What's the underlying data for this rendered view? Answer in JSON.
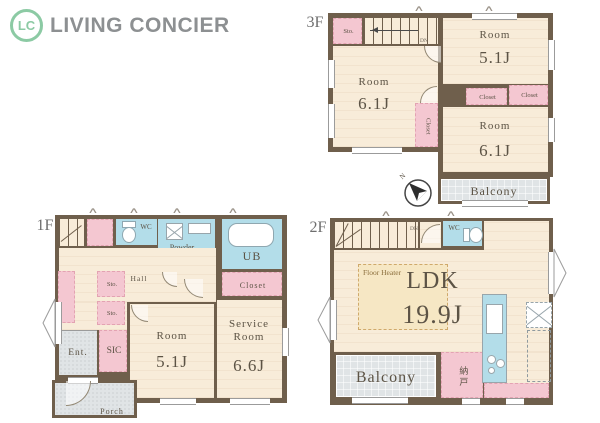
{
  "logo": {
    "mark": "LC",
    "name": "LIVING CONCIER"
  },
  "colors": {
    "wall": "#6f5f4c",
    "floor": "#f8ecd9",
    "pink": "#f4c7d1",
    "wet_blue": "#b3dde9",
    "outdoor_gray": "#e0e4e6",
    "logo_green": "#8ccaa4",
    "logo_gray": "#8d9092",
    "label_brown": "#5c5345",
    "laundry_red": "#cc4444"
  },
  "icons": {
    "vent": "∧",
    "compass": "north-arrow"
  },
  "f3": {
    "label": "3F",
    "sto": "Sto.",
    "dn": "DN",
    "room_a_name": "Room",
    "room_a_size": "6.1J",
    "room_b_name": "Room",
    "room_b_size": "5.1J",
    "room_c_name": "Room",
    "room_c_size": "6.1J",
    "closet_a": "Closet",
    "closet_b": "Closet",
    "closet_c": "Closet",
    "balcony": "Balcony",
    "compass_n": "N"
  },
  "f1": {
    "label": "1F",
    "up": "UP",
    "wc": "WC",
    "powder_room": "Powder Room",
    "laundry": "洗濯機置場",
    "ub": "UB",
    "closet": "Closet",
    "hall": "Hall",
    "sto_a": "Sto.",
    "sto_b": "Sto.",
    "ent": "Ent.",
    "sic": "SIC",
    "room_name": "Room",
    "room_size": "5.1J",
    "service_name": "Service Room",
    "service_size": "6.6J",
    "porch": "Porch"
  },
  "f2": {
    "label": "2F",
    "up": "UP",
    "dn": "DN",
    "wc": "WC",
    "floor_heater": "Floor Heater",
    "ldk_name": "LDK",
    "ldk_size": "19.9J",
    "balcony": "Balcony",
    "nando": "納戸"
  }
}
